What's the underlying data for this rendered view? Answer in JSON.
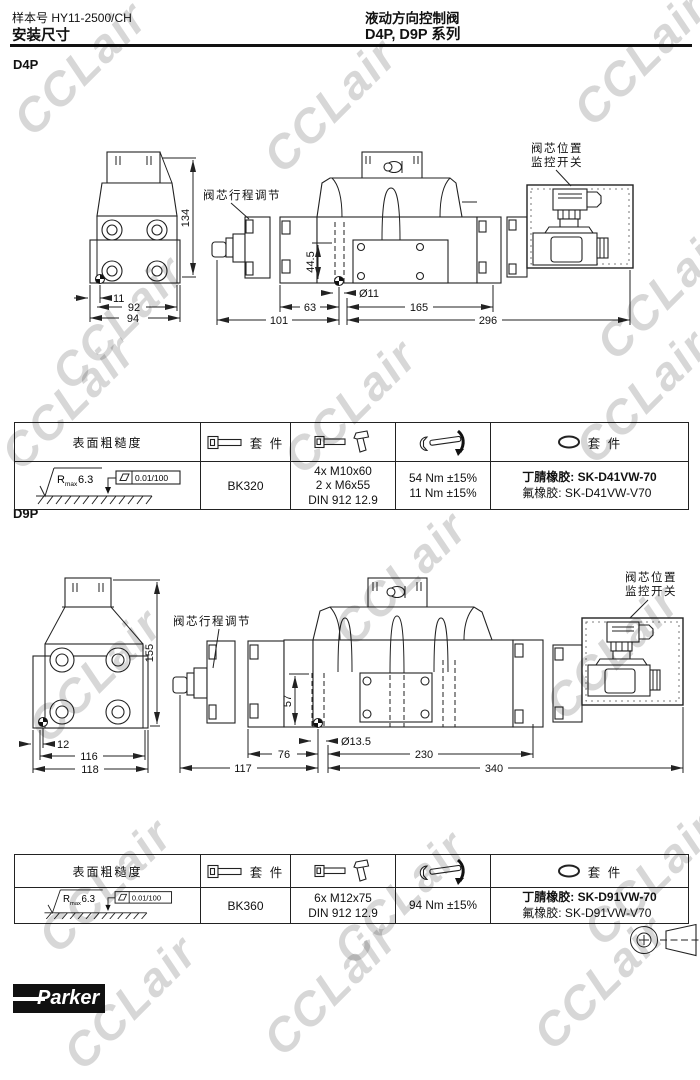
{
  "header": {
    "catalog_label": "样本号 HY11-2500/CH",
    "page_title": "安装尺寸",
    "product_title": "液动方向控制阀",
    "series_title": "D4P, D9P 系列"
  },
  "watermark": {
    "text": "CCLair"
  },
  "d4p": {
    "label": "D4P",
    "stroke_adjust_label": "阀芯行程调节",
    "switch_label_1": "阀芯位置",
    "switch_label_2": "监控开关",
    "dims": {
      "height": "134",
      "offset": "11",
      "width_inner": "92",
      "width_outer": "94",
      "pad_height": "44.5",
      "hole_dia": "Ø11",
      "len_a": "63",
      "len_b": "165",
      "len_c": "101",
      "len_total": "296"
    }
  },
  "d9p": {
    "label": "D9P",
    "stroke_adjust_label": "阀芯行程调节",
    "switch_label_1": "阀芯位置",
    "switch_label_2": "监控开关",
    "dims": {
      "height": "155",
      "offset": "12",
      "width_inner": "116",
      "width_outer": "118",
      "pad_height": "57",
      "hole_dia": "Ø13.5",
      "len_a": "76",
      "len_b": "230",
      "len_c": "117",
      "len_total": "340"
    }
  },
  "table": {
    "col_roughness": "表面粗糙度",
    "col_kit": "套 件",
    "col_seal_kit": "套 件",
    "roughness": {
      "r": "R",
      "sub": "max",
      "value": "6.3",
      "flatness": "0.01/100"
    }
  },
  "table_d4p": {
    "bolt_kit": "BK320",
    "screw_1": "4x M10x60",
    "screw_2": "2 x M6x55",
    "screw_3": "DIN 912 12.9",
    "torque_1": "54 Nm ±15%",
    "torque_2": "11 Nm ±15%",
    "seal_1": "丁腈橡胶: SK-D41VW-70",
    "seal_2": "氟橡胶: SK-D41VW-V70"
  },
  "table_d9p": {
    "bolt_kit": "BK360",
    "screw_1": "6x M12x75",
    "screw_2": "DIN 912 12.9",
    "torque_1": "94 Nm ±15%",
    "seal_1": "丁腈橡胶: SK-D91VW-70",
    "seal_2": "氟橡胶: SK-D91VW-V70"
  },
  "footer": {
    "brand": "Parker"
  }
}
